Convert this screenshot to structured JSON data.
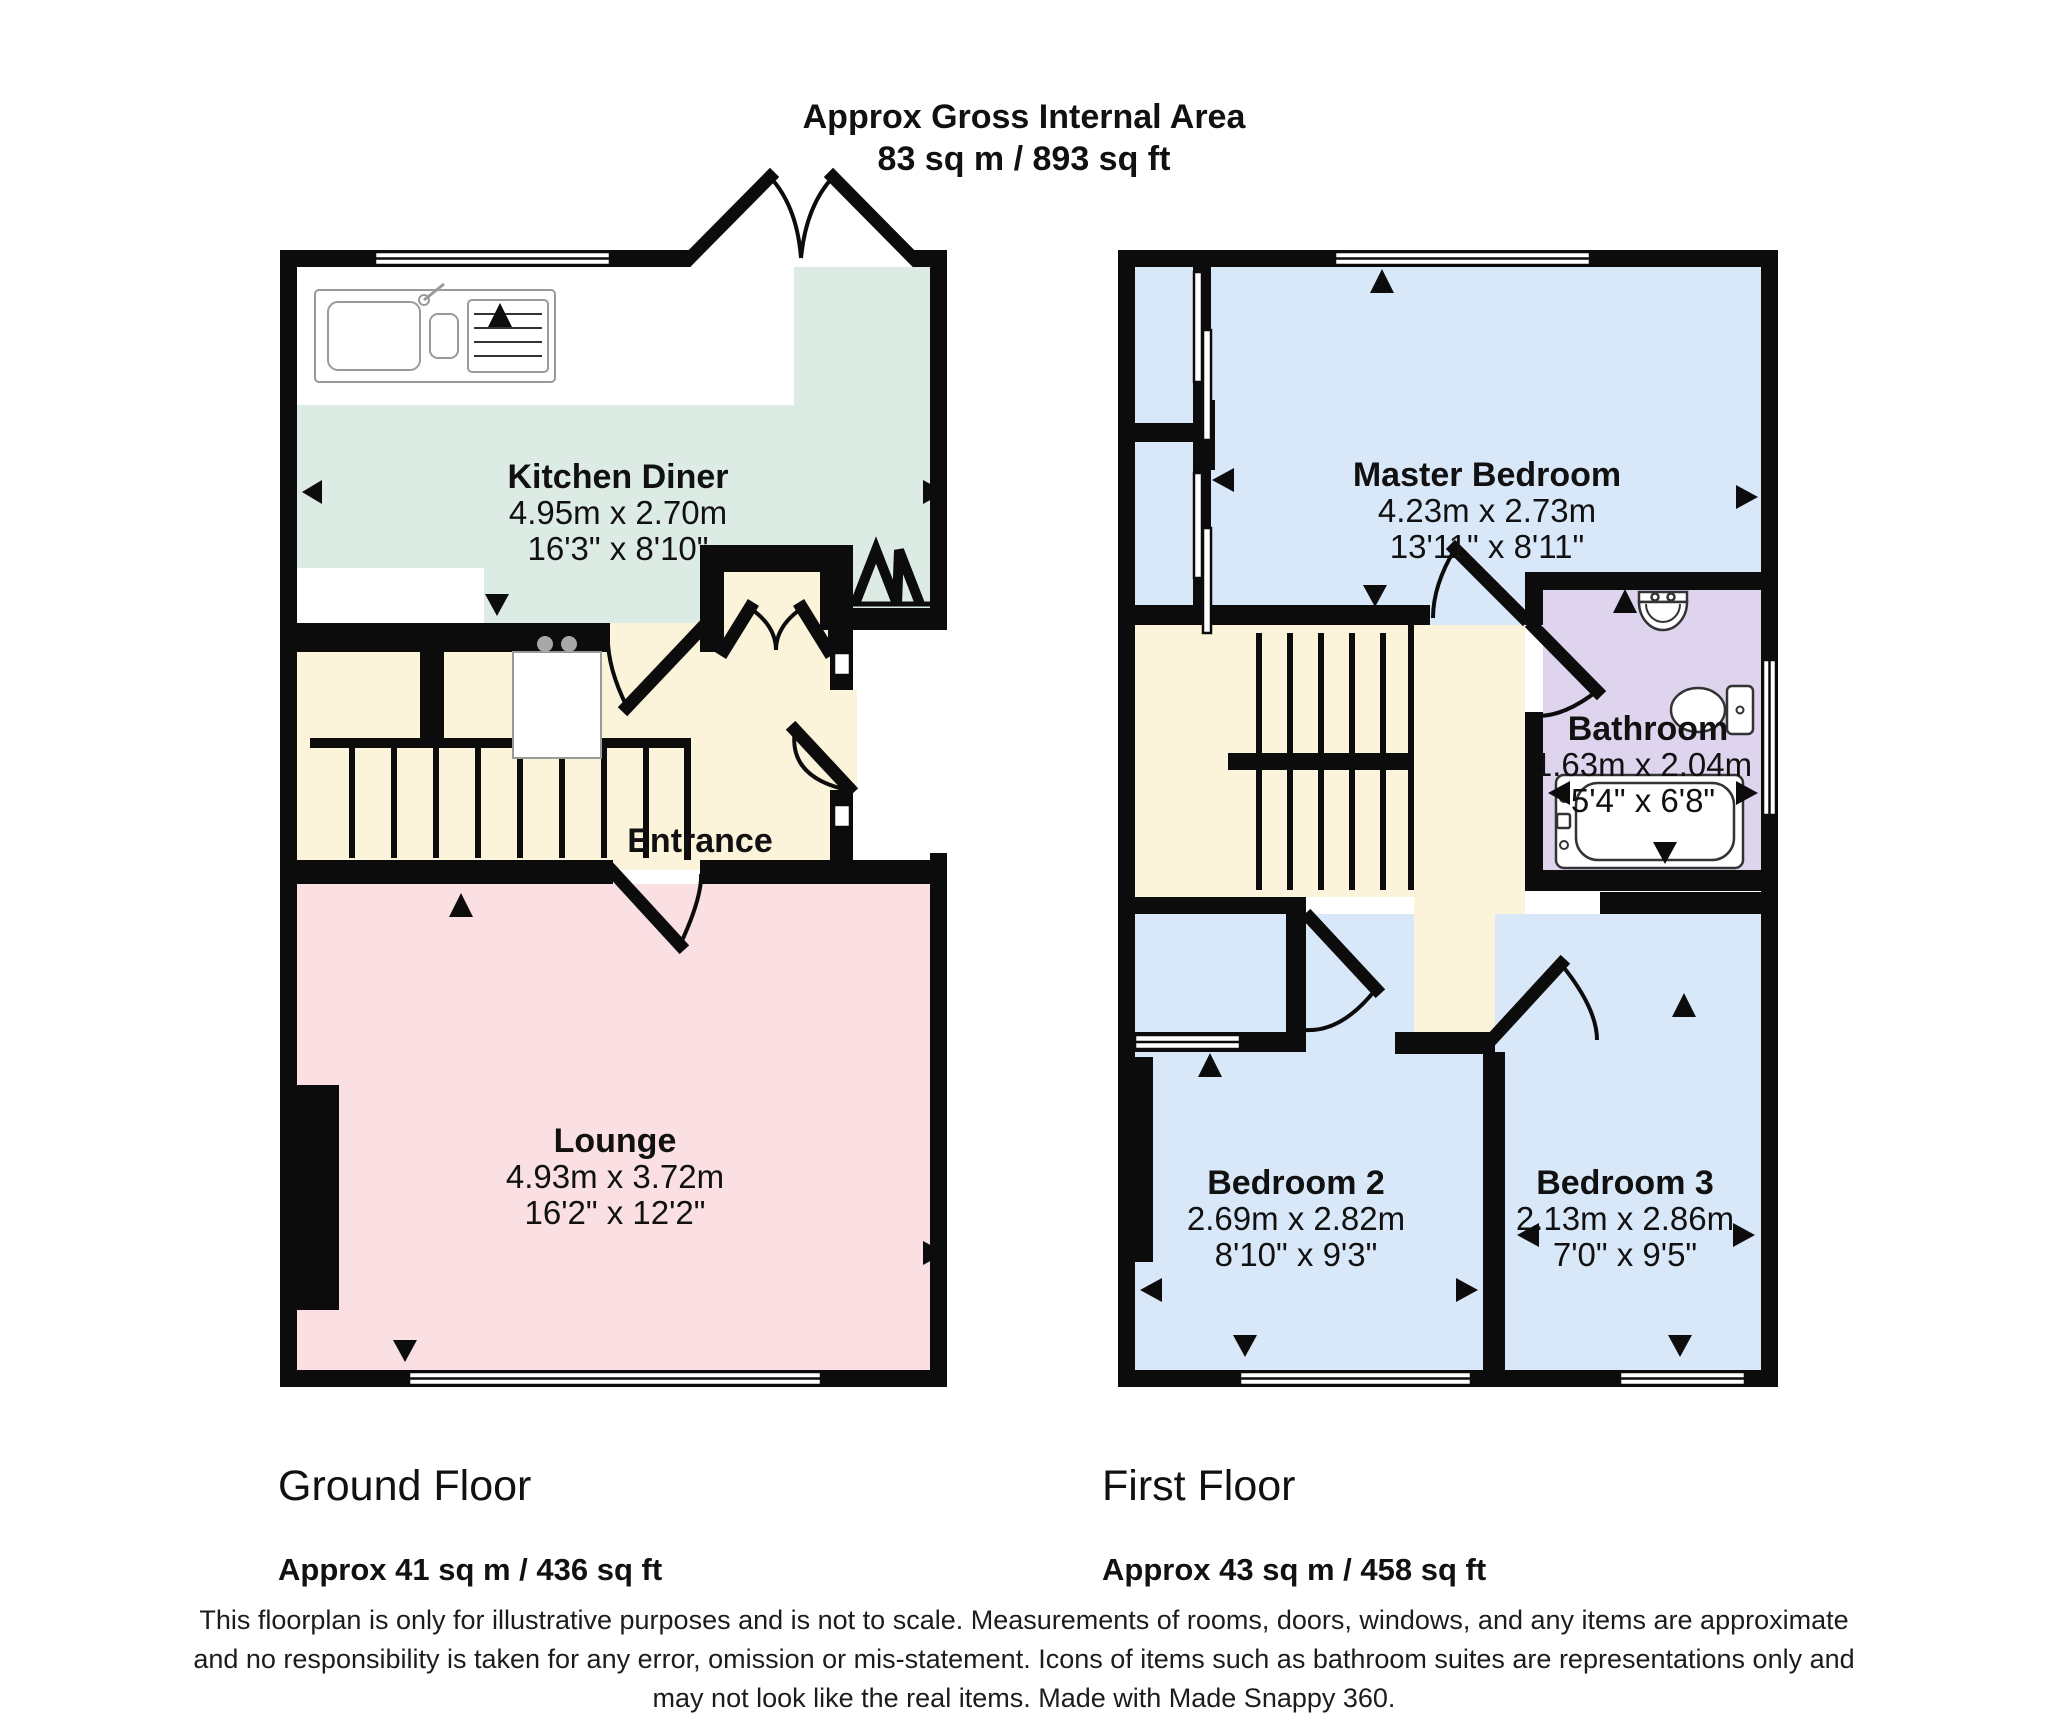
{
  "header": {
    "title": "Approx Gross Internal Area",
    "area": "83 sq m / 893 sq ft"
  },
  "rooms": {
    "kitchen": {
      "name": "Kitchen Diner",
      "metric": "4.95m x 2.70m",
      "imperial": "16'3\" x 8'10\""
    },
    "entrance": {
      "name": "Entrance"
    },
    "lounge": {
      "name": "Lounge",
      "metric": "4.93m x 3.72m",
      "imperial": "16'2\" x 12'2\""
    },
    "master": {
      "name": "Master Bedroom",
      "metric": "4.23m x 2.73m",
      "imperial": "13'11\" x 8'11\""
    },
    "bathroom": {
      "name": "Bathroom",
      "metric": "1.63m x 2.04m",
      "imperial": "5'4\" x 6'8\""
    },
    "bedroom2": {
      "name": "Bedroom 2",
      "metric": "2.69m x 2.82m",
      "imperial": "8'10\" x 9'3\""
    },
    "bedroom3": {
      "name": "Bedroom 3",
      "metric": "2.13m x 2.86m",
      "imperial": "7'0\" x 9'5\""
    }
  },
  "floors": {
    "ground": {
      "name": "Ground Floor",
      "area": "Approx 41 sq m / 436 sq ft"
    },
    "first": {
      "name": "First Floor",
      "area": "Approx 43 sq m / 458 sq ft"
    }
  },
  "disclaimer": {
    "line1": "This floorplan is only for illustrative purposes and is not to scale. Measurements of rooms, doors, windows, and any items are approximate",
    "line2": "and no responsibility is taken for any error, omission or mis-statement. Icons of items such as bathroom suites are representations only and",
    "line3": "may not look like the real items. Made with Made Snappy 360."
  },
  "colors": {
    "wall": "#0c0c0c",
    "kitchen": "#dcebe4",
    "hall": "#fbf3da",
    "lounge": "#fadfe3",
    "bedroom": "#d9e8f8",
    "bathroom": "#ded4ee"
  }
}
